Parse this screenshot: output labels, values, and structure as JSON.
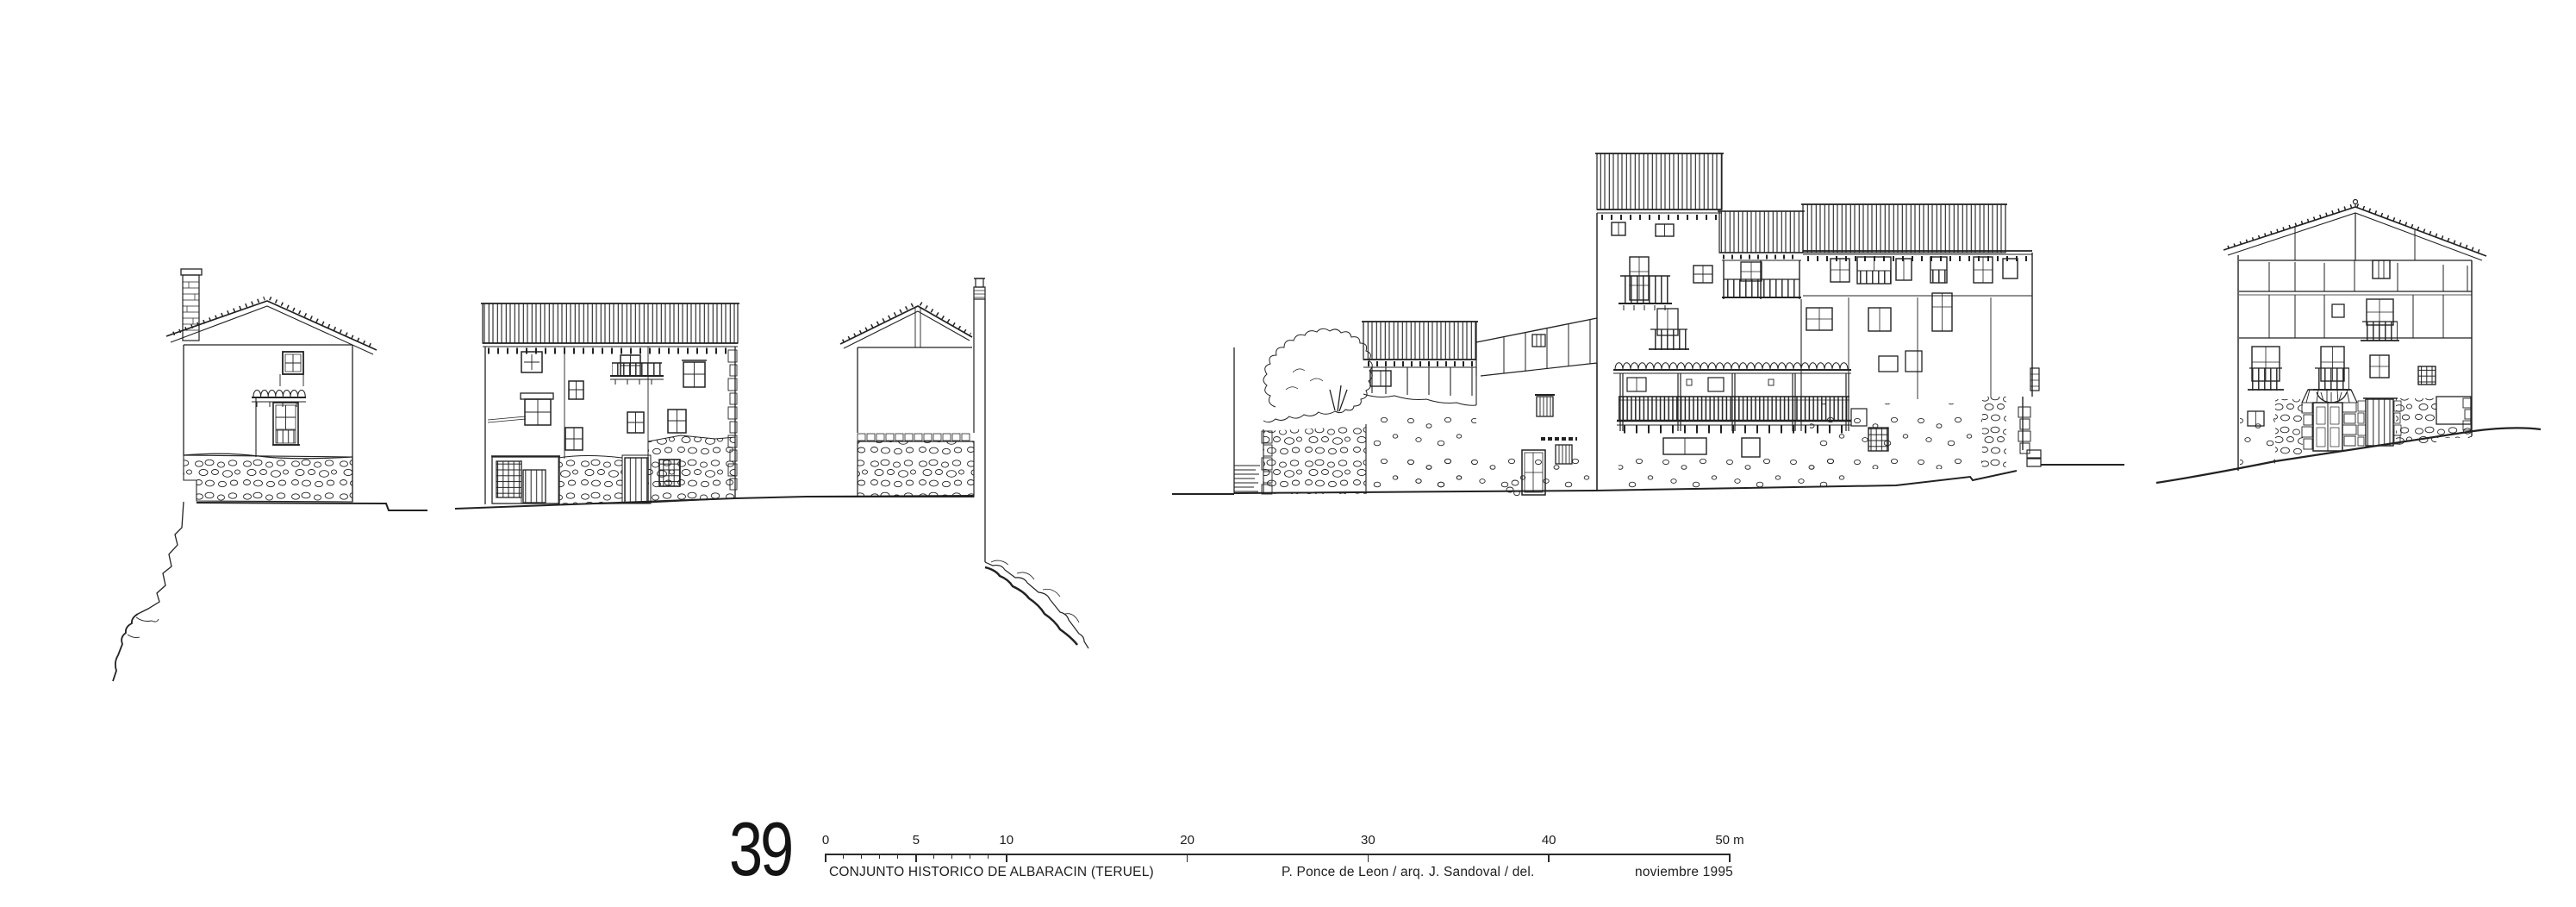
{
  "colors": {
    "ink": "#222222",
    "paper": "#ffffff"
  },
  "title_block": {
    "sheet_number": "39",
    "project_title": "CONJUNTO HISTORICO DE ALBARACIN (TERUEL)",
    "architect_credit": "P. Ponce de Leon / arq.",
    "delineator_credit": "J. Sandoval / del.",
    "date": "noviembre 1995"
  },
  "scale_bar": {
    "unit": "m",
    "total_meters": 50,
    "major_ticks": [
      {
        "m": 0,
        "label": "0"
      },
      {
        "m": 5,
        "label": "5"
      },
      {
        "m": 10,
        "label": "10"
      },
      {
        "m": 20,
        "label": "20"
      },
      {
        "m": 30,
        "label": "30"
      },
      {
        "m": 40,
        "label": "40"
      },
      {
        "m": 50,
        "label": "50 m"
      }
    ],
    "minor_ticks_m": [
      1,
      2,
      3,
      4,
      6,
      7,
      8,
      9
    ]
  },
  "drawing": {
    "description": "Ink street elevations of five traditional houses on rocky terrain",
    "buildings": [
      "gabled house with chimney on cliff edge",
      "wide two-house facade with round-tile eave",
      "gable-end section with tall chimney over rocks",
      "large stepped complex with tower and long wooden gallery",
      "three-storey half-timbered house on sloping street"
    ]
  }
}
